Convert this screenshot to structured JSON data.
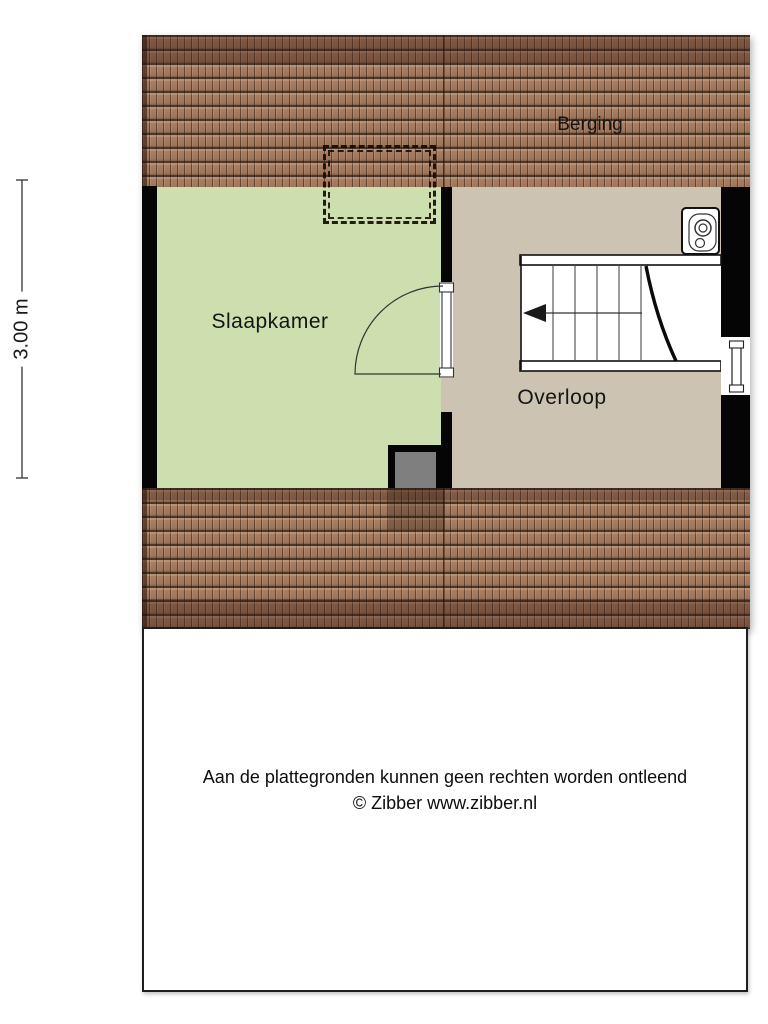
{
  "plan": {
    "room_slaapkamer_label": "Slaapkamer",
    "room_overloop_label": "Overloop",
    "berging_label": "Berging",
    "dim_vertical": "3.00 m",
    "dim_slaapkamer_width": "2.80 m",
    "dim_overloop_width": "2.63 m",
    "colors": {
      "room_slaapkamer": "#cddfae",
      "room_overloop": "#cdc3b3",
      "roof_tile": "#aa7e61",
      "roof_ridge": "#7a4c3a",
      "wall": "#050505",
      "duct_gray": "#7f7f7f"
    },
    "icons": {
      "staircase": "stairs with down arrow",
      "ventilation_unit": "mechanical ventilation unit",
      "door": "door with swing arc",
      "window": "window in right wall",
      "dormer_outline": "dashed overhead outline"
    }
  },
  "footer": {
    "disclaimer": "Aan de plattegronden kunnen geen rechten worden ontleend",
    "copyright": "© Zibber www.zibber.nl"
  }
}
